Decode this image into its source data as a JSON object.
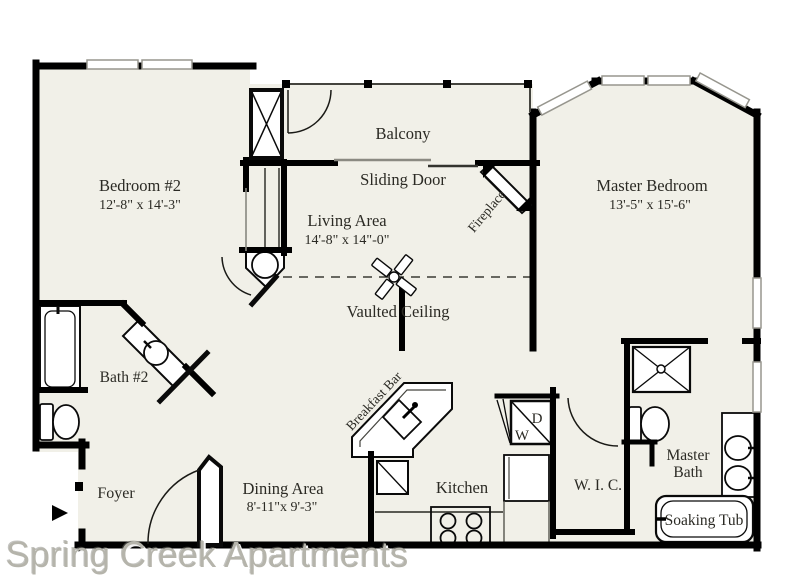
{
  "watermark": "Spring Creek Apartments",
  "colors": {
    "floor": "#f1f0e8",
    "wall": "#000000",
    "watermark": "#b5b4ab"
  },
  "rooms": {
    "bedroom2": {
      "name": "Bedroom #2",
      "dims": "12'-8\" x 14'-3\""
    },
    "living_area": {
      "name": "Living Area",
      "dims": "14'-8\" x 14\"-0\""
    },
    "master_bedroom": {
      "name": "Master Bedroom",
      "dims": "13'-5\" x 15'-6\""
    },
    "dining_area": {
      "name": "Dining Area",
      "dims": "8'-11\"x 9'-3\""
    },
    "kitchen": {
      "name": "Kitchen"
    },
    "foyer": {
      "name": "Foyer"
    },
    "bath2": {
      "name": "Bath #2"
    },
    "master_bath": {
      "line1": "Master",
      "line2": "Bath"
    },
    "wic": {
      "name": "W. I. C."
    },
    "balcony": {
      "name": "Balcony"
    }
  },
  "features": {
    "sliding_door": "Sliding Door",
    "fireplace": "Fireplace",
    "vaulted_ceiling": "Vaulted Ceiling",
    "breakfast_bar": "Breakfast Bar",
    "soaking_tub": "Soaking Tub",
    "dryer_label": "D",
    "washer_label": "W"
  }
}
